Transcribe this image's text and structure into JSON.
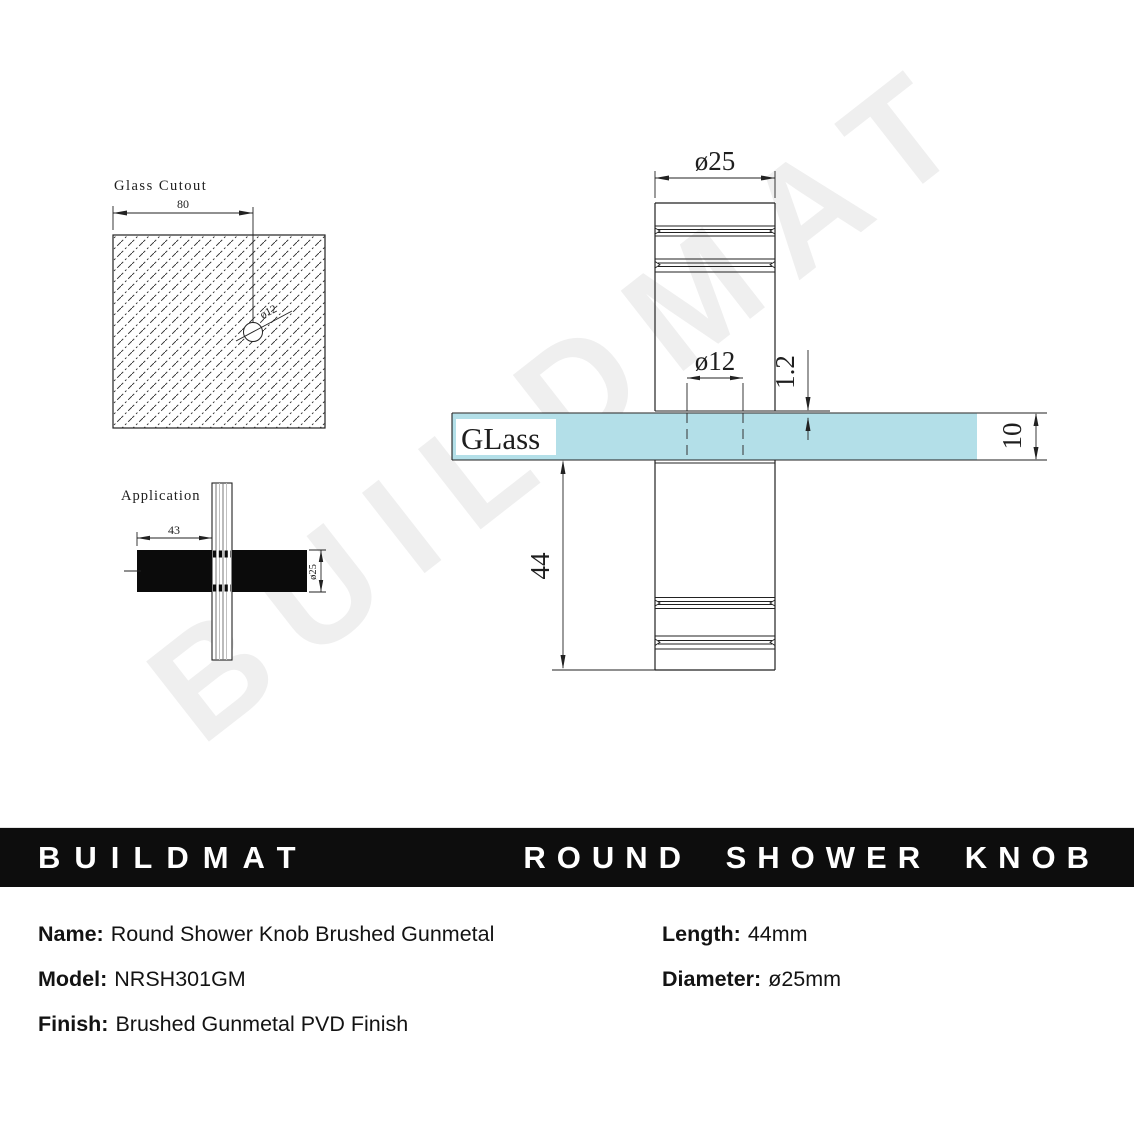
{
  "watermark": "BUILDMAT",
  "drawing": {
    "glass_cutout": {
      "title": "Glass Cutout",
      "width_dim": "80",
      "hole_dim": "ø12"
    },
    "application": {
      "title": "Application",
      "width_dim": "43",
      "diameter_dim": "ø25"
    },
    "main_view": {
      "diameter_dim": "ø25",
      "hole_dim": "ø12",
      "gap_dim": "1.2",
      "glass_label": "GLass",
      "glass_thickness_dim": "10",
      "length_dim": "44"
    }
  },
  "banner": {
    "brand": "BUILDMAT",
    "product": "ROUND SHOWER KNOB"
  },
  "specs": {
    "name_label": "Name:",
    "name_value": "Round Shower Knob Brushed Gunmetal",
    "model_label": "Model:",
    "model_value": "NRSH301GM",
    "finish_label": "Finish:",
    "finish_value": "Brushed Gunmetal PVD Finish",
    "length_label": "Length:",
    "length_value": "44mm",
    "diameter_label": "Diameter:",
    "diameter_value": "ø25mm"
  },
  "colors": {
    "glass_blue": "#b3dfe8",
    "banner_black": "#0d0d0d",
    "line": "#222222",
    "watermark_gray": "#efefef"
  }
}
